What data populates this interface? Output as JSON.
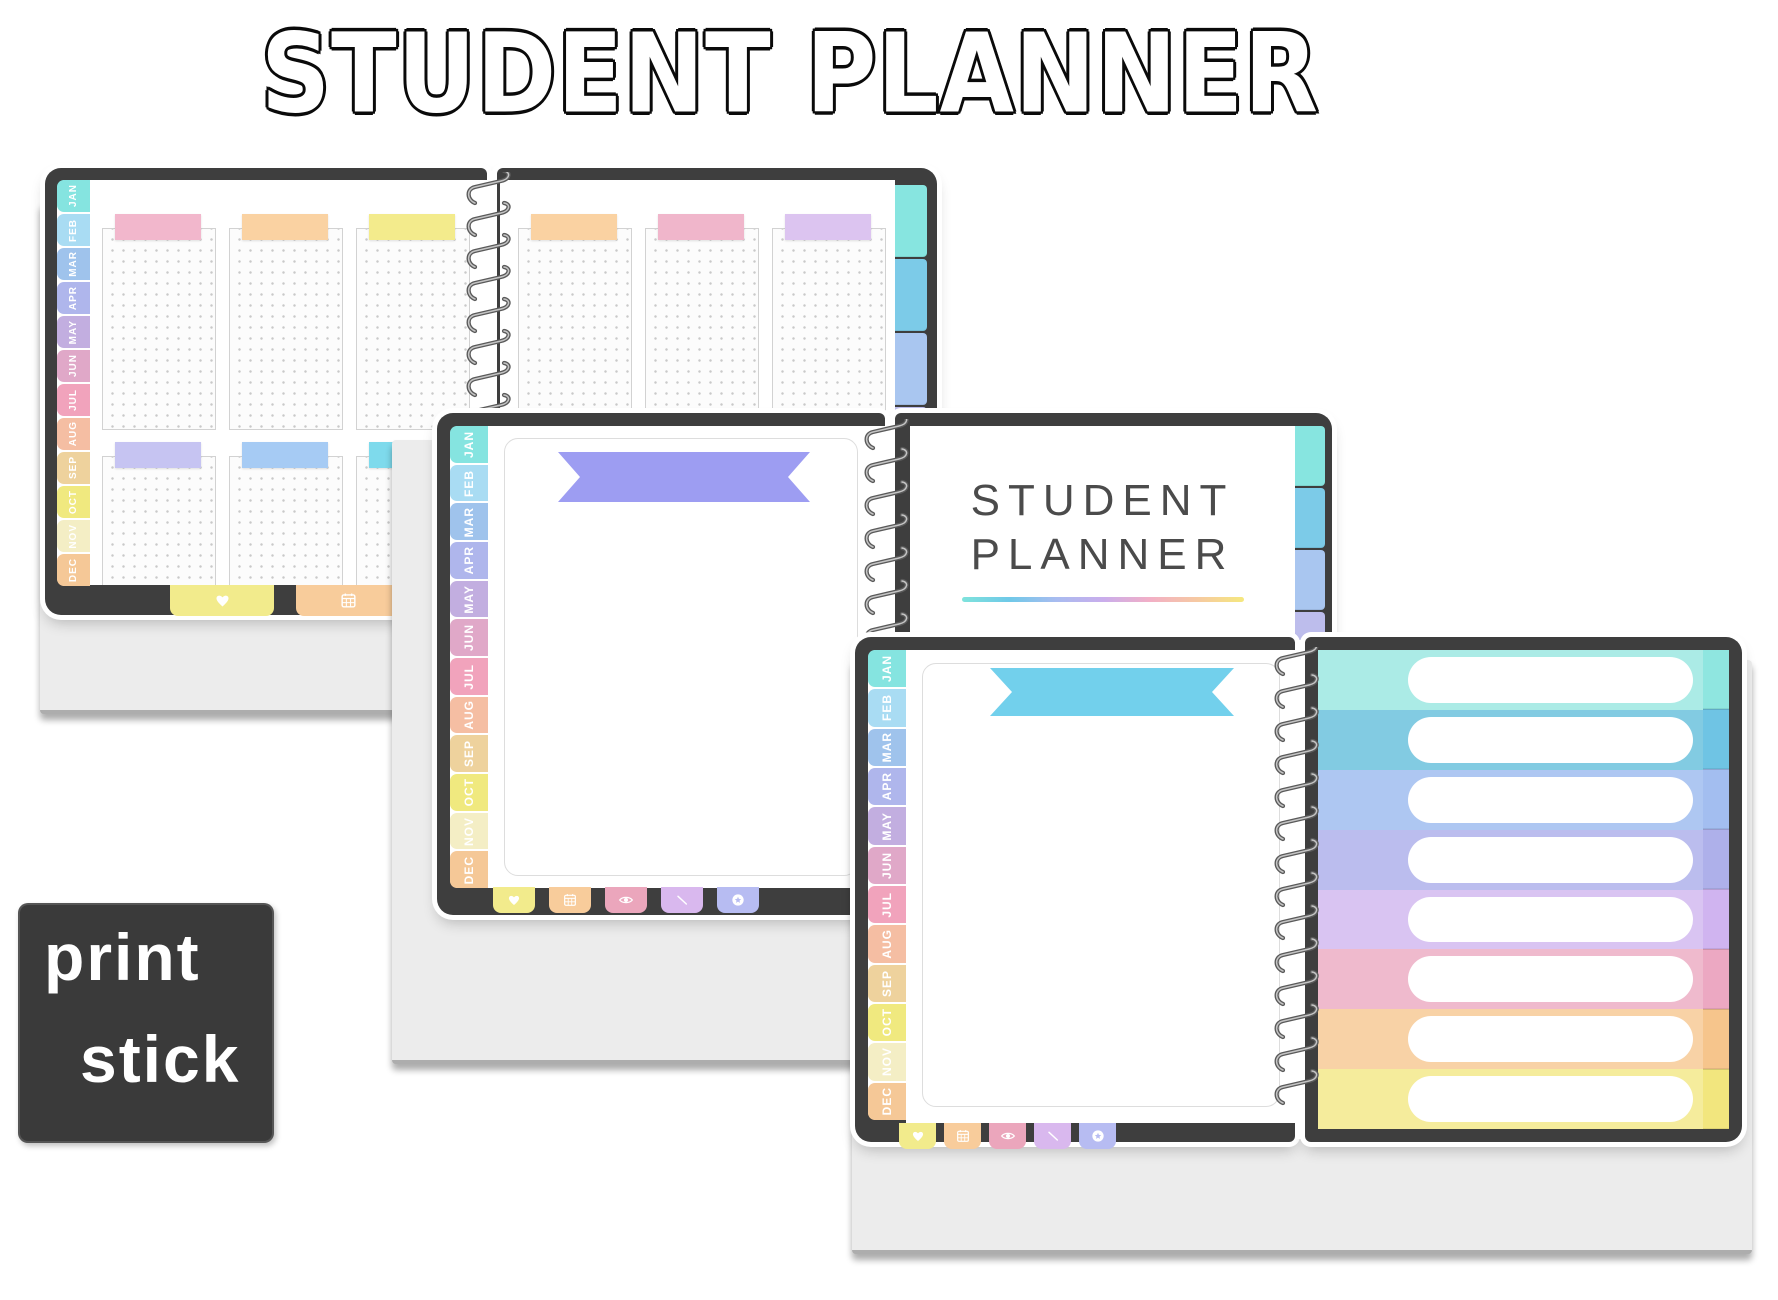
{
  "title": "STUDENT PLANNER",
  "months": [
    "JAN",
    "FEB",
    "MAR",
    "APR",
    "MAY",
    "JUN",
    "JUL",
    "AUG",
    "SEP",
    "OCT",
    "NOV",
    "DEC"
  ],
  "month_tab_colors": [
    "#85E4E0",
    "#A9DCF3",
    "#9FC3EC",
    "#AFB6EC",
    "#C2AEE0",
    "#E0A8C8",
    "#F1A3BC",
    "#F5BEA3",
    "#EED29D",
    "#F0E97F",
    "#F4EEC5",
    "#F5C897"
  ],
  "edge_tab_colors": [
    "#87E5E0",
    "#7CCBE8",
    "#A9C6F0",
    "#BDBDEC",
    "#CBB5EE"
  ],
  "icon_tabs": [
    {
      "name": "heart",
      "color": "#F2EB8C"
    },
    {
      "name": "calendar",
      "color": "#F8CC9B"
    },
    {
      "name": "eye",
      "color": "#EBA6BC"
    },
    {
      "name": "pen",
      "color": "#D9B8EE"
    },
    {
      "name": "star",
      "color": "#B7BCF2"
    }
  ],
  "planner1": {
    "left_header_colors": [
      "#F2B7CC",
      "#FAD2A2",
      "#F3EB8C",
      "#C6C4F2",
      "#A6CBF4",
      "#7EDAEC"
    ],
    "right_header_colors": [
      "#FAD2A2",
      "#F0B6CB",
      "#DCC4F0"
    ]
  },
  "planner2": {
    "banner_color": "#9D9DF2",
    "cover_line1": "STUDENT",
    "cover_line2": "PLANNER",
    "underline_colors": [
      "#7FE3DC",
      "#6FC9E8",
      "#A8BCF0",
      "#C9ADEC",
      "#F2AFC6",
      "#F6C9A2",
      "#F5E87E"
    ]
  },
  "planner3": {
    "banner_color": "#72D0EC",
    "row_colors": [
      "#ABEBE6",
      "#82CBE2",
      "#AEC7F2",
      "#BBBDEE",
      "#D9C4F2",
      "#EFBACD",
      "#F8D2A6",
      "#F5EC9C"
    ],
    "row_edge_colors": [
      "#8FE6E0",
      "#6FC4E4",
      "#A3BEF0",
      "#AEB0EA",
      "#D0B4F0",
      "#ECA8C2",
      "#F6C58C",
      "#F2E67E"
    ]
  },
  "logo": {
    "line1": "print",
    "line2": "stick",
    "bg": "#3A3A3A"
  },
  "frame_color": "#3E3E3E",
  "desk_color": "#ECECEC"
}
